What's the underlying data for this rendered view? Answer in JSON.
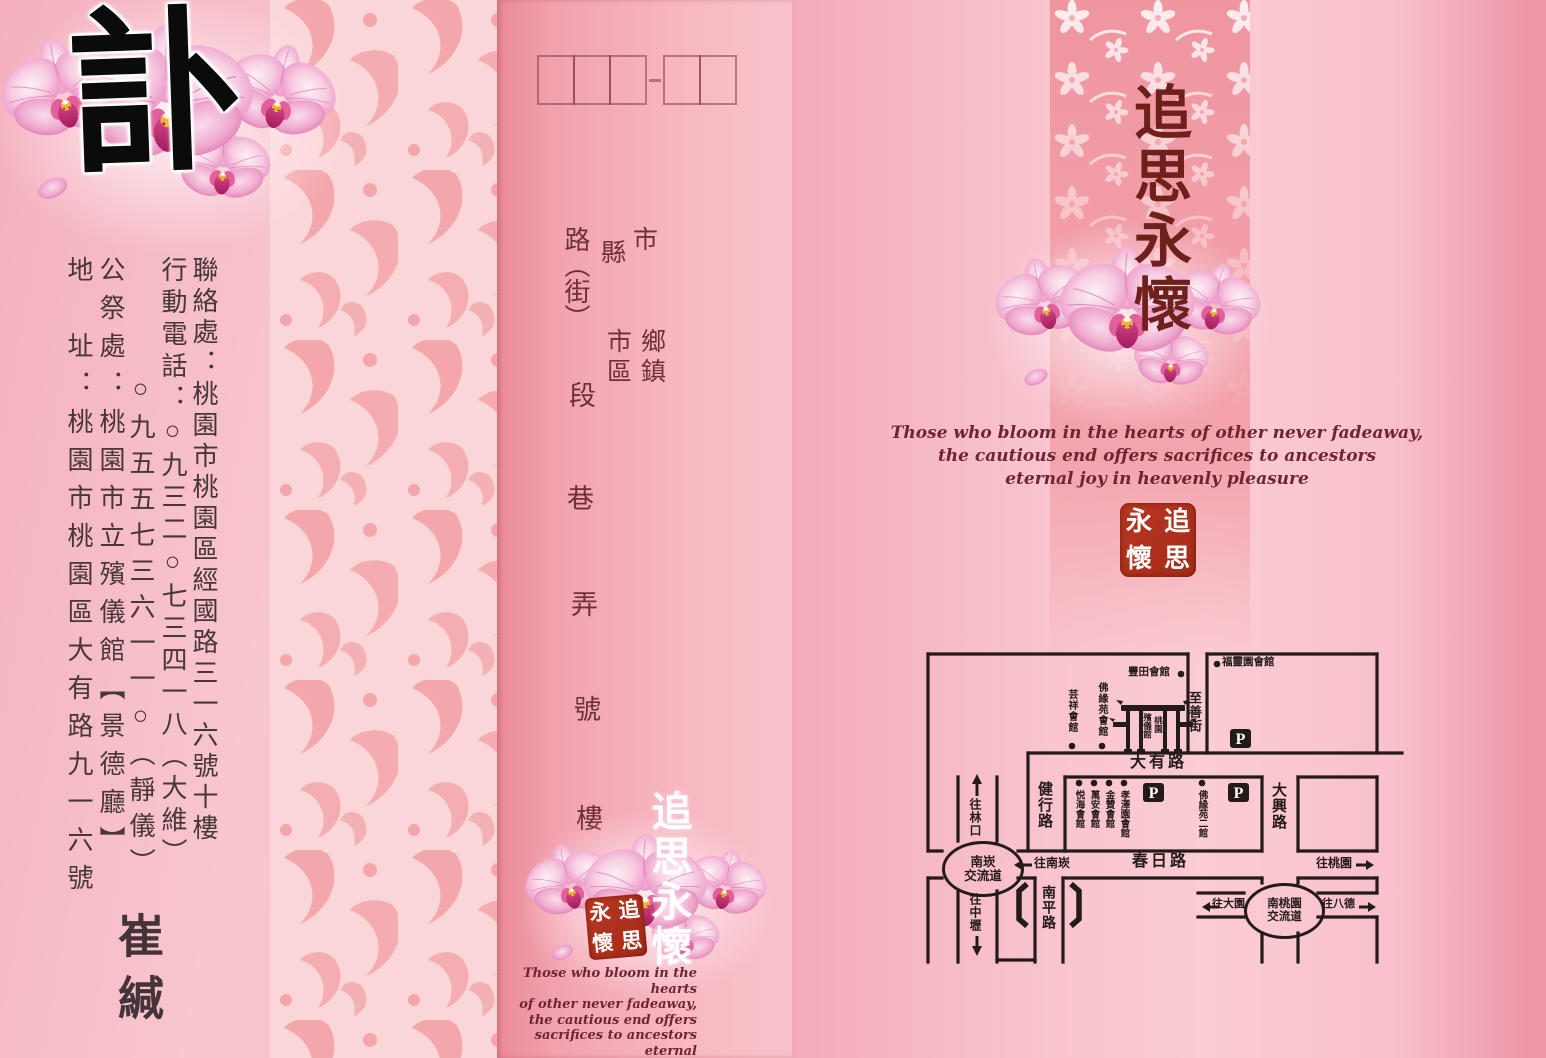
{
  "card": {
    "left": {
      "title": "訃",
      "contact": {
        "line1": "聯絡處：桃園市桃園區經國路三一六號十樓",
        "line2": "行動電話：○九三二○七三四一八（大維）",
        "line3": "○九五五七三六一一○（靜儀）",
        "line4": "公祭處：桃園市立殯儀館【景德廳】",
        "line5": "地　址：桃園市桃園區大有路九一六號"
      },
      "signature": "崔緘"
    },
    "middle": {
      "postal_box_groups": [
        3,
        2
      ],
      "address_form": {
        "city_label": "市",
        "county_label": "縣",
        "township": "鄉",
        "town": "鎮",
        "urban_city": "市",
        "district": "區",
        "road": "路（街）",
        "section": "段",
        "lane": "巷",
        "alley": "弄",
        "number": "號",
        "floor": "樓"
      },
      "memorial_title": "追思永懷",
      "seal": [
        "追",
        "思",
        "永",
        "懷"
      ],
      "english": [
        "Those who bloom in the hearts",
        "of other never fadeaway,",
        "the cautious end offers",
        "sacrifices to ancestors eternal",
        "joy in heavenly pleasure"
      ]
    },
    "right": {
      "title": "追思永懷",
      "english": [
        "Those who bloom in the hearts of other never fadeaway,",
        "the cautious end offers sacrifices to ancestors",
        "eternal joy in heavenly pleasure"
      ],
      "seal": [
        "追",
        "思",
        "永",
        "懷"
      ],
      "map": {
        "roads": {
          "dayou": "大有路",
          "jianxing": "健行路",
          "chunri": "春日路",
          "daxing": "大興路",
          "nanping": "南平路",
          "zhishan": "至善街"
        },
        "venues": {
          "fengtian": "豐田會館",
          "fuling": "福靈園會館",
          "yunxiang": "芸祥會館",
          "foyuan": "佛緣苑會館",
          "yuehai": "悦海會館",
          "wanan": "萬安會館",
          "jinzan": "金贊會館",
          "xiaoze": "孝澤園會館",
          "foyuan2": "佛緣苑二館"
        },
        "gate": {
          "name_left": "殯儀館",
          "name_right": "桃園"
        },
        "interchanges": {
          "nankan_1": "南崁",
          "nankan_2": "交流道",
          "nantaoyuan_1": "南桃園",
          "nantaoyuan_2": "交流道"
        },
        "directions": {
          "linkou": "往林口",
          "zhongli": "往中壢",
          "nankan": "往南崁",
          "taoyuan": "往桃園",
          "dayuan": "往大園",
          "bade": "往八德"
        },
        "parking_label": "P"
      }
    },
    "colors": {
      "ink": "#241a17",
      "maroon_title": "#6e211b",
      "english_text": "#6f2433",
      "seal_red": "#b03220",
      "panel_pink": "#f6b7c2",
      "band_salmon": "#f2a0a9",
      "white_text": "#ffffff"
    }
  }
}
